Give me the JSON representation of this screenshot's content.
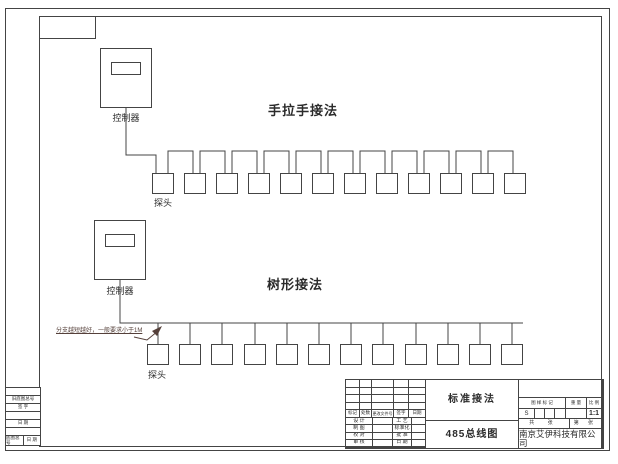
{
  "page": {
    "background": "#ffffff",
    "line_color": "#444444",
    "ink_color": "#2b2b2b",
    "annotation_color": "#55403a"
  },
  "diagram": {
    "daisy": {
      "title": "手拉手接法",
      "controller_label": "控制器",
      "probe_label": "探头",
      "probe_count": 12
    },
    "tree": {
      "title": "树形接法",
      "controller_label": "控制器",
      "probe_label": "探头",
      "probe_count": 12,
      "annotation": "分支越短越好，一般要求小于1M"
    }
  },
  "title_block": {
    "rev_header": [
      "标记",
      "处数",
      "更改文件号",
      "签字",
      "日期"
    ],
    "roles": [
      [
        "设 计",
        "工 艺"
      ],
      [
        "制 图",
        "标准化"
      ],
      [
        "校 对",
        "批 准"
      ],
      [
        "审 核",
        "日 期"
      ]
    ],
    "drawing_name": "标准接法",
    "drawing_number": "485总线图",
    "headers": {
      "mark": "图 样 标 记",
      "weight": "重 量",
      "scale": "比 例"
    },
    "values": {
      "mark": "S",
      "scale": "1:1"
    },
    "sheet": {
      "total": "共  张",
      "page": "第  张"
    },
    "company": "南京艾伊科技有限公司"
  },
  "side_block": {
    "rows": [
      "",
      "旧底图总号",
      "签 字",
      "",
      "日 期",
      ""
    ],
    "bottom_row": [
      "底图总号",
      "日 期"
    ]
  }
}
